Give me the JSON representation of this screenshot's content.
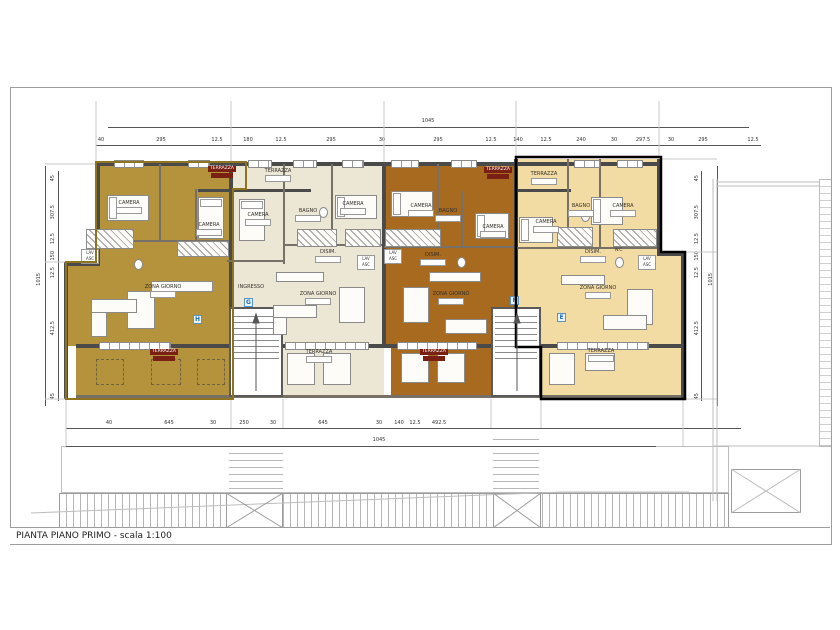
{
  "sheet": {
    "title": "PIANTA PIANO PRIMO - scala 1:100"
  },
  "colors": {
    "unit_h_fill": "#b5923c",
    "unit_g_fill": "#ece6d4",
    "unit_f_fill": "#a76a1e",
    "unit_e_fill": "#f3dba4",
    "unit_h_outline": "#8f7420",
    "unit_e_outline": "#000000",
    "terrace_chip": "#7a2012",
    "badge_color": "#1f6fb5"
  },
  "badges": {
    "h": "H",
    "g": "G",
    "f": "F",
    "e": "E"
  },
  "rooms": {
    "camera": "CAMERA",
    "bagno": "BAGNO",
    "disimpegno": "DISIM.",
    "terrazza": "TERRAZZA",
    "zona_giorno": "ZONA GIORNO",
    "ingresso": "INGRESSO",
    "wc": "W.C.",
    "lav": "LAV",
    "asc": "ASC"
  },
  "dims": {
    "overall_width_top": "1045",
    "overall_width_bottom": "1045",
    "overall_height_left": "1015",
    "overall_height_right": "1015",
    "top": [
      "40",
      "295",
      "12.5",
      "180",
      "12.5",
      "295",
      "30",
      "295",
      "12.5",
      "140",
      "12.5",
      "240",
      "30",
      "297.5",
      "30",
      "295",
      "12.5"
    ],
    "bottom": [
      "40",
      "645",
      "30",
      "250",
      "30",
      "645",
      "30",
      "140",
      "12.5",
      "492.5"
    ],
    "left": [
      "45",
      "307.5",
      "12.5",
      "150",
      "12.5",
      "412.5",
      "45"
    ],
    "right": [
      "45",
      "307.5",
      "12.5",
      "150",
      "12.5",
      "412.5",
      "45"
    ]
  }
}
